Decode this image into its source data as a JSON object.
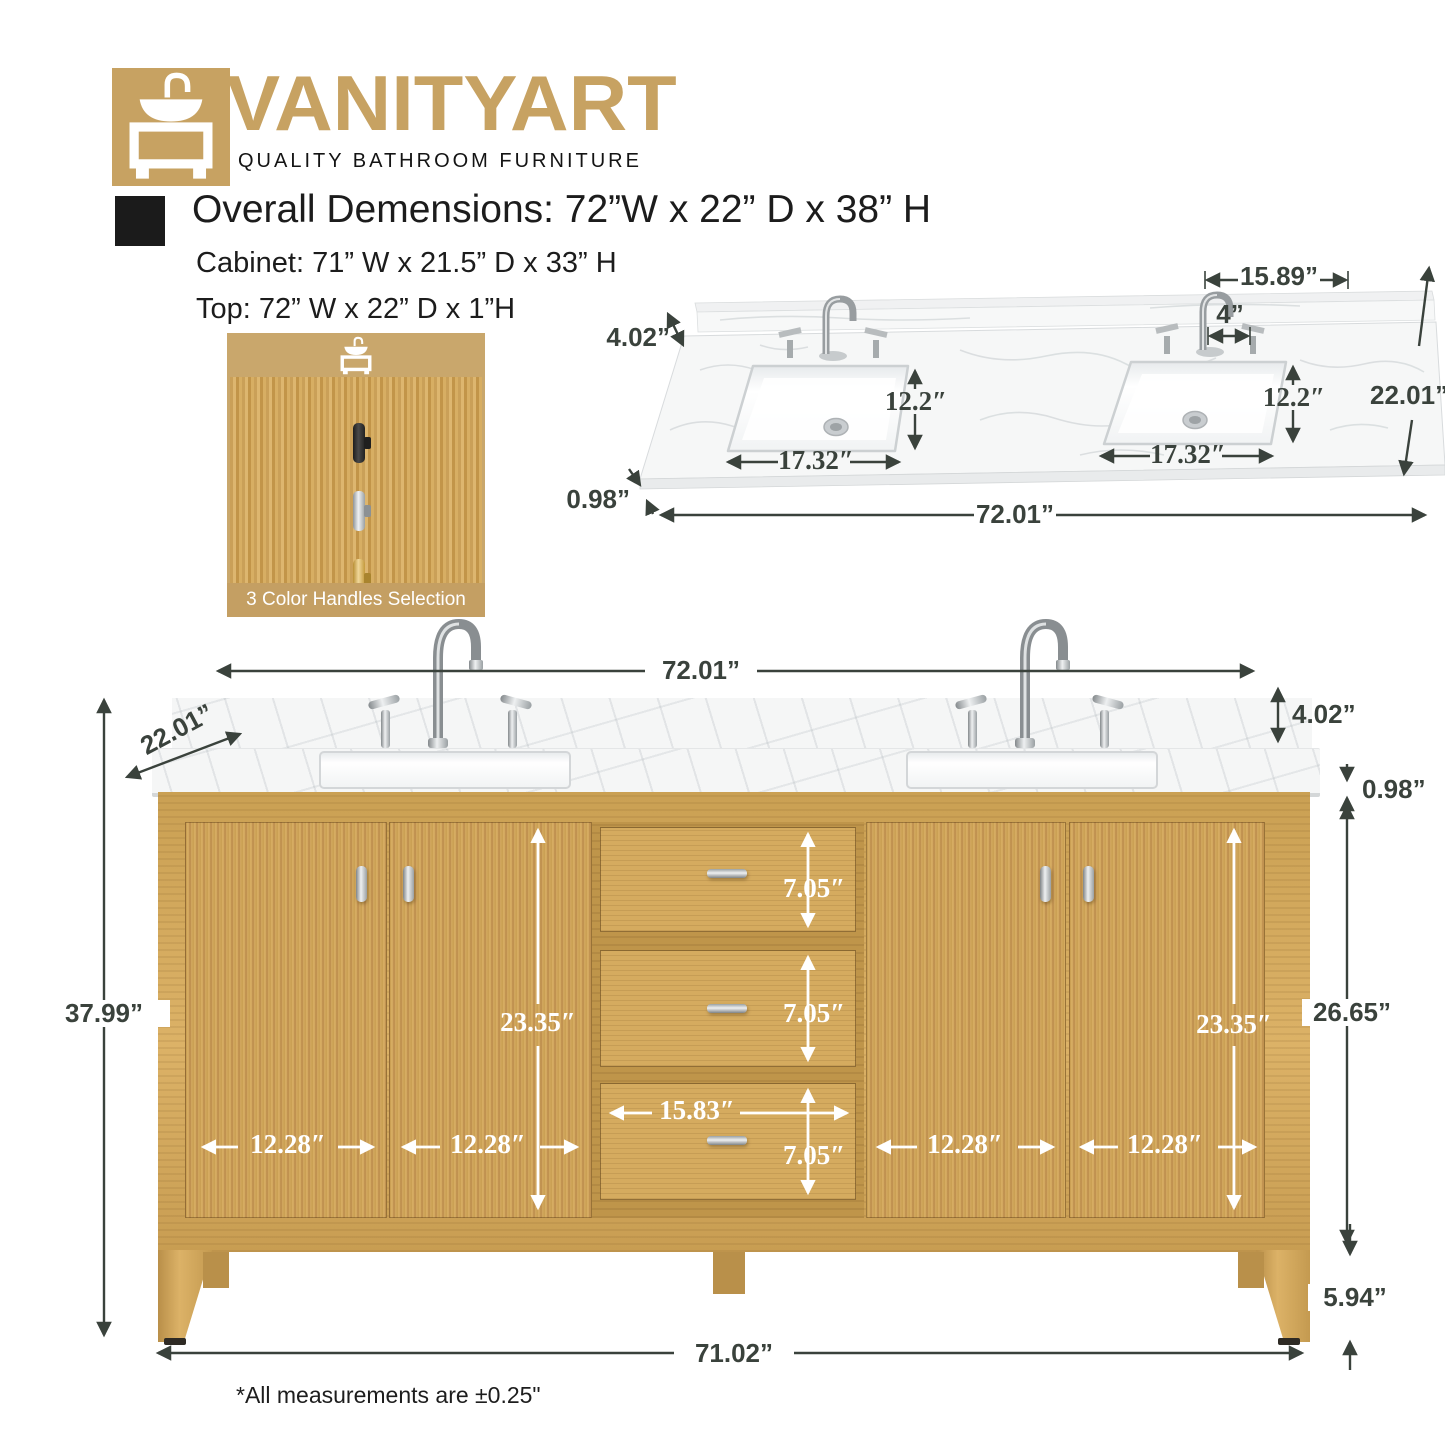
{
  "brand": {
    "name": "VANITYART",
    "tagline": "QUALITY BATHROOM FURNITURE"
  },
  "specs": {
    "overall": "Overall Demensions: 72”W x 22” D x 38” H",
    "cabinet": "Cabinet: 71” W x 21.5” D x 33” H",
    "top": "Top: 72” W x 22” D x 1”H"
  },
  "handles_card": {
    "caption": "3 Color Handles Selection",
    "options": [
      "black",
      "chrome",
      "gold"
    ]
  },
  "top_view": {
    "dims": {
      "backsplash_right": "15.89”",
      "hole_spacing": "4”",
      "backsplash_height": "4.02”",
      "sink_depth_left": "12.2″",
      "sink_depth_right": "12.2″",
      "depth": "22.01”",
      "sink_width_left": "17.32″",
      "sink_width_right": "17.32″",
      "thickness": "0.98”",
      "width": "72.01”"
    }
  },
  "front_view": {
    "dims": {
      "width_top": "72.01”",
      "depth": "22.01”",
      "backsplash_height": "4.02”",
      "thickness": "0.98”",
      "height": "37.99”",
      "cabinet_side": "26.65”",
      "leg": "5.94”",
      "width_bottom": "71.02”",
      "opening_left": "23.35″",
      "opening_right": "23.35″",
      "drawer_1": "7.05″",
      "drawer_2": "7.05″",
      "drawer_3": "7.05″",
      "drawer_w": "15.83″",
      "door_1": "12.28″",
      "door_2": "12.28″",
      "door_3": "12.28″",
      "door_4": "12.28″"
    }
  },
  "footnote": "*All measurements are ±0.25\""
}
